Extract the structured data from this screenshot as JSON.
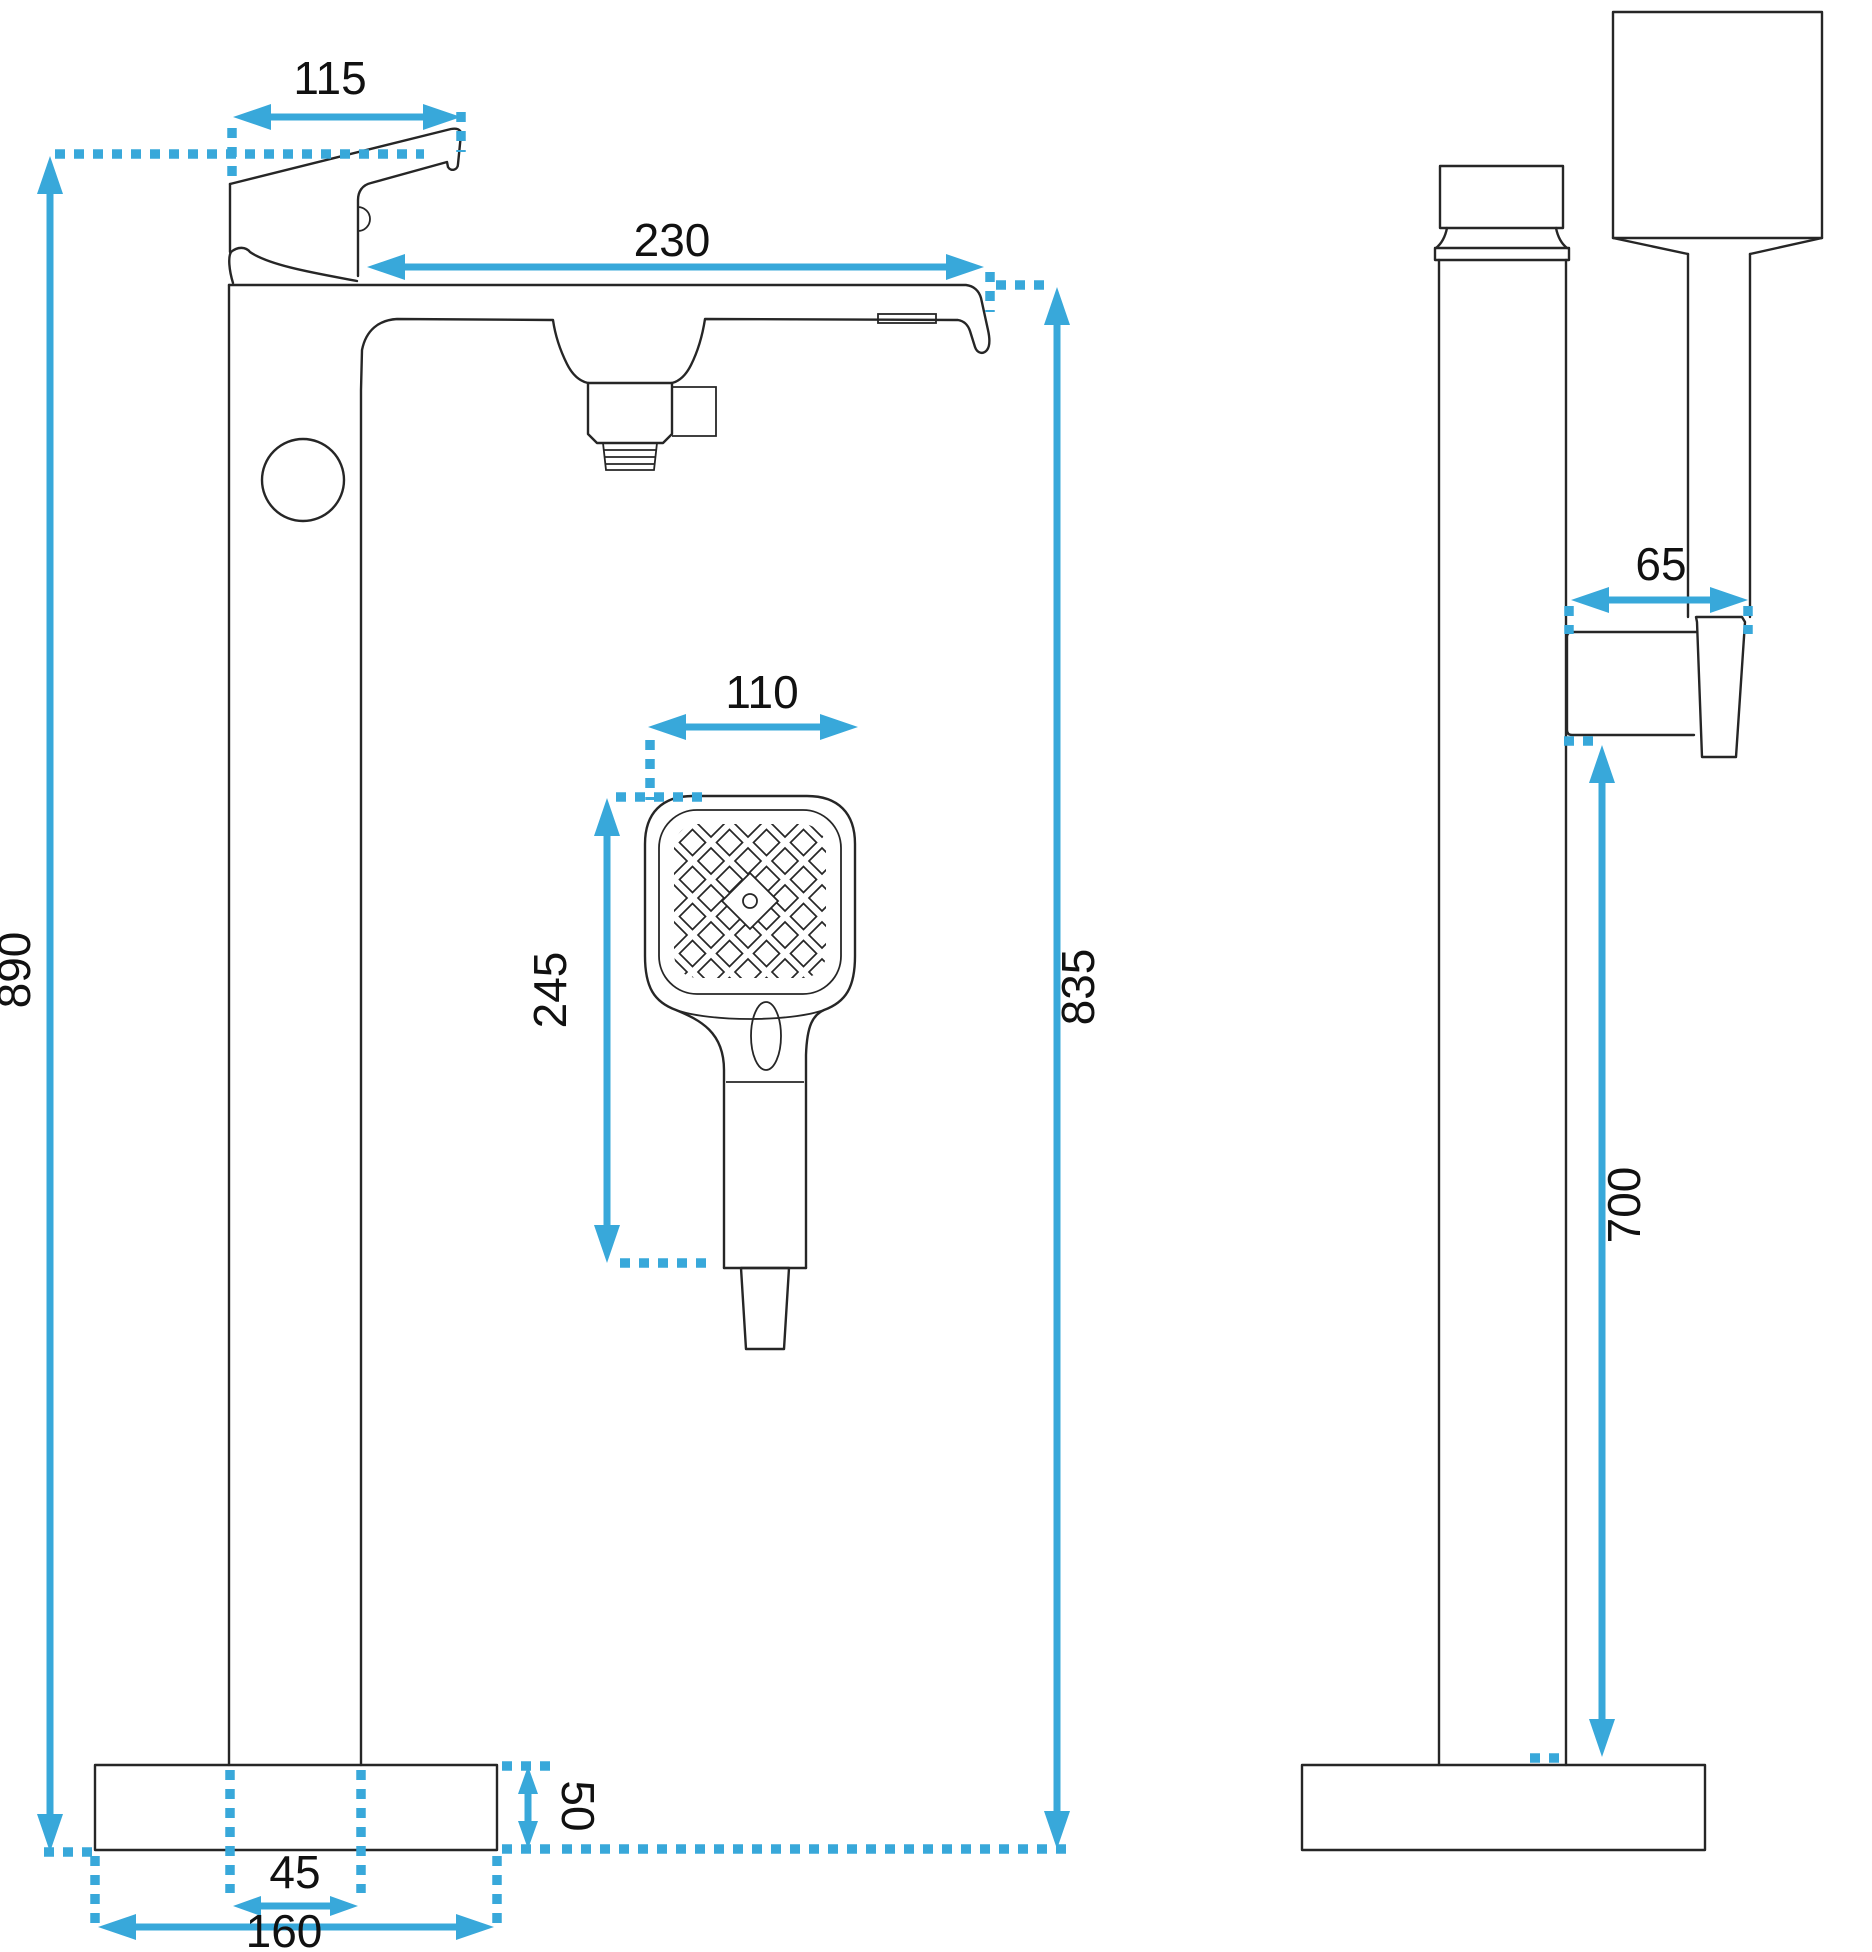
{
  "figure": {
    "type": "technical-dimension-drawing",
    "subject": "freestanding bathtub faucet with hand shower",
    "unit": "mm",
    "views": [
      "front",
      "side"
    ]
  },
  "colors": {
    "dimension_accent": "#38a8da",
    "outline": "#262626",
    "background": "#ffffff"
  },
  "front_view": {
    "dims": {
      "handle_length": "115",
      "spout_reach": "230",
      "total_height": "890",
      "spout_top_height": "835",
      "handset_width": "110",
      "handset_length": "245",
      "base_height": "50",
      "column_width": "45",
      "base_width": "160"
    }
  },
  "side_view": {
    "dims": {
      "holder_depth": "65",
      "holder_height": "700"
    }
  }
}
